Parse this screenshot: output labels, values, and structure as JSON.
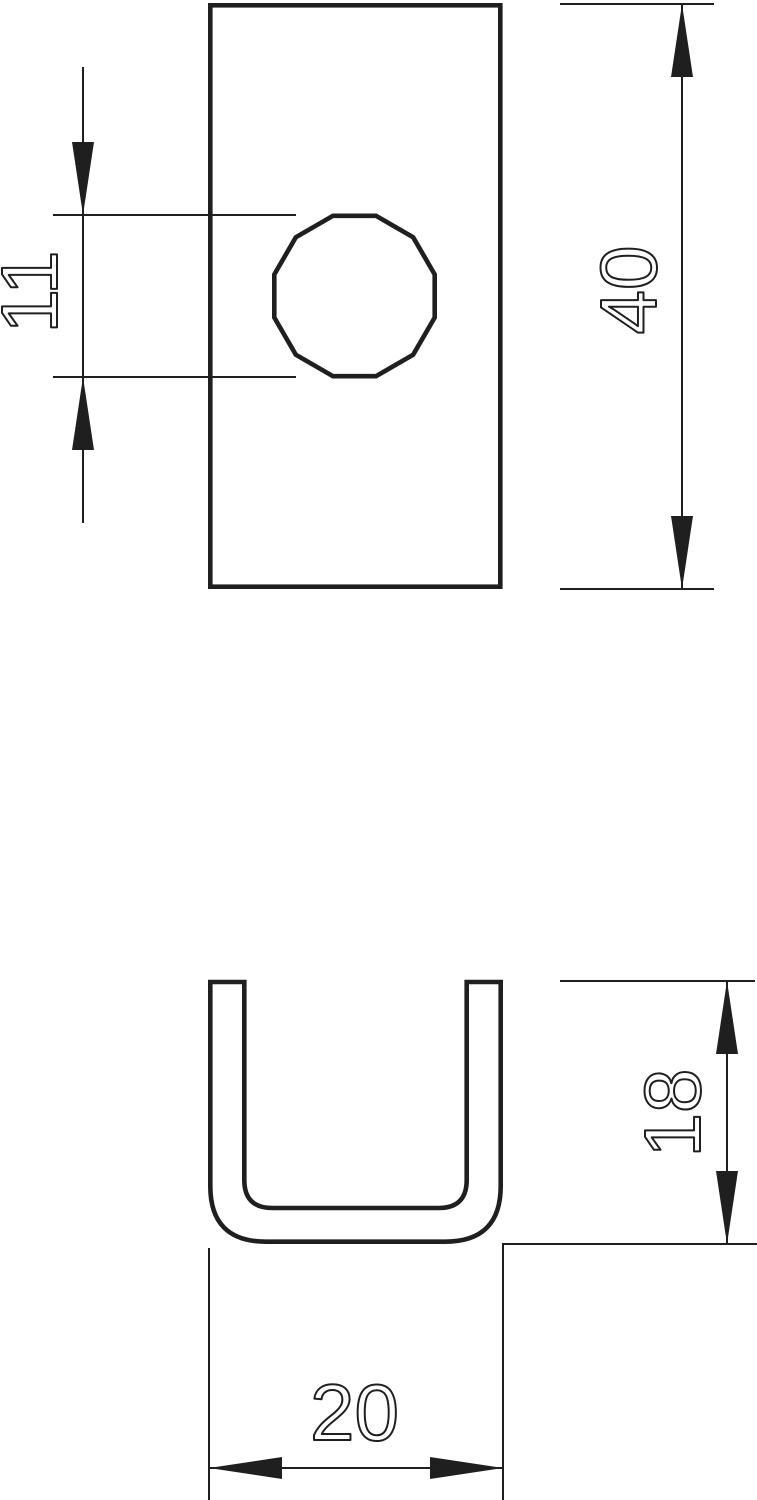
{
  "drawing": {
    "background_color": "#ffffff",
    "line_color": "#1f1f1f",
    "views": [
      {
        "id": "front-view",
        "description": "rectangular plate with round hole"
      },
      {
        "id": "profile-view",
        "description": "U-shaped channel profile"
      }
    ],
    "dimensions": {
      "hole_diameter": {
        "label": "11",
        "value": 11
      },
      "plate_height": {
        "label": "40",
        "value": 40
      },
      "profile_height": {
        "label": "18",
        "value": 18
      },
      "profile_width": {
        "label": "20",
        "value": 20
      }
    }
  }
}
